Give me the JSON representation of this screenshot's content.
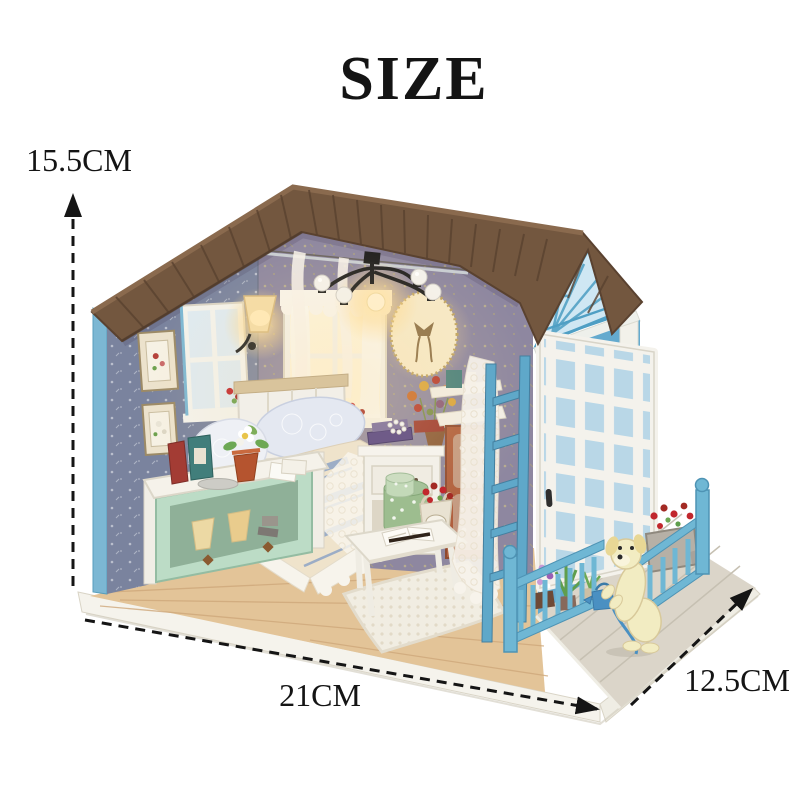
{
  "title": {
    "text": "SIZE"
  },
  "dimensions": {
    "height": {
      "label": "15.5CM",
      "icon": "dashed-arrow-up-icon"
    },
    "width": {
      "label": "21CM",
      "icon": "dashed-arrow-right-icon"
    },
    "depth": {
      "label": "12.5CM",
      "icon": "dashed-arrow-up-right-icon"
    }
  },
  "scene": {
    "subject": "diy-miniature-dollhouse-room",
    "elements": [
      "roof",
      "wallpapered-walls",
      "bed",
      "bench",
      "side-table",
      "nightstand",
      "chandelier",
      "wall-sconce",
      "lace-window",
      "oval-frame",
      "white-lattice-door",
      "blue-porch-fence",
      "puppy-figurine",
      "flower-planters",
      "wood-base"
    ]
  },
  "palette": {
    "page-bg": "#ffffff",
    "ink": "#141414",
    "roof": "#73573f",
    "roof-dark": "#5a4230",
    "roof-light": "#8a6a4e",
    "wall-left": "#7e87a2",
    "wall-back": "#8e87a0",
    "edge-blue": "#7cb7d3",
    "right-blue": "#64aace",
    "gable-blue": "#5fa8c9",
    "fence-blue": "#6fb7d4",
    "floor-wood": "#e3c498",
    "deck-grey": "#dbd5c9",
    "base-white": "#f5f3ec",
    "mint": "#bcdcc6",
    "furn-white": "#f4f1e9",
    "duvet-cream": "#efe3cb",
    "stripe-blue": "#94a8c6",
    "lace-white": "#f8f4ec",
    "glow-amber": "#ffd98c",
    "dog-cream": "#f2ecc2",
    "berry-red": "#c1272d",
    "leaf-green": "#6da854",
    "terracotta": "#b5542f",
    "cabinet-brown": "#b05f3e"
  }
}
